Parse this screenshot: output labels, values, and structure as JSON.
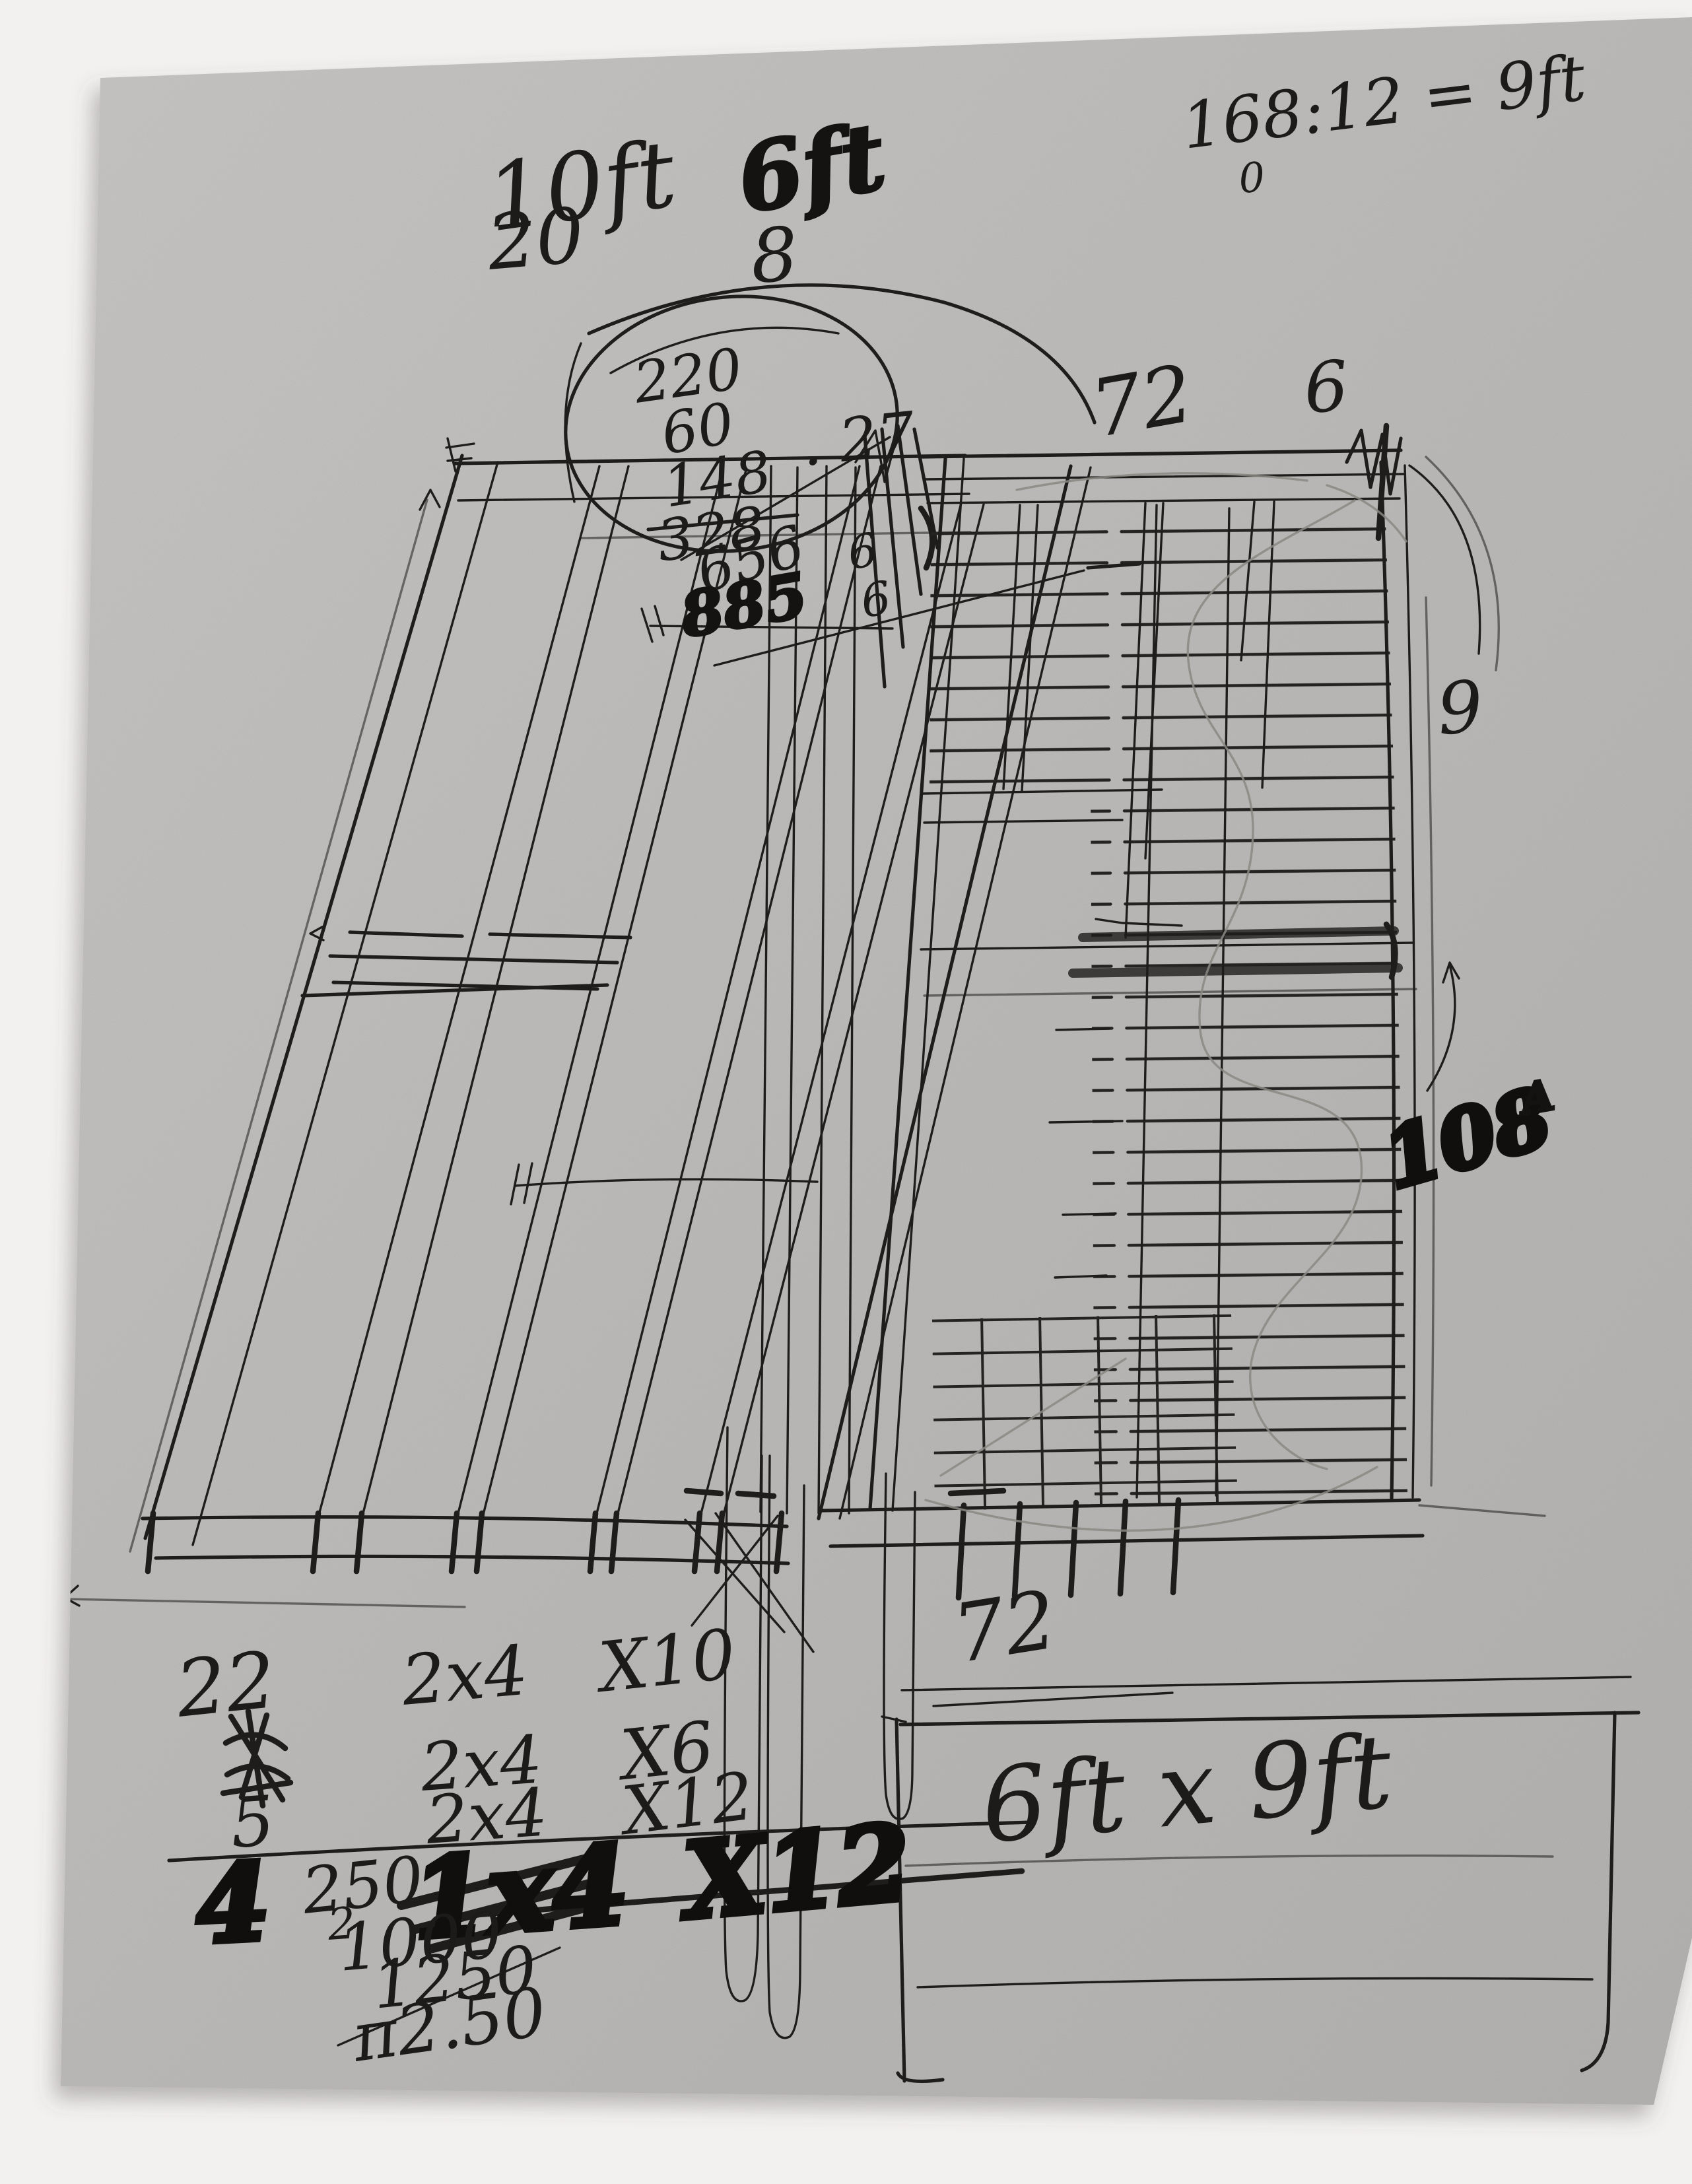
{
  "scene": {
    "background_color": "#f2f1ef",
    "paper_color": "#c2c1bf",
    "ink_color": "#1e1d1b",
    "pencil_color": "#8a8882"
  },
  "a": {
    "top": {
      "w10": "10ft",
      "w10_sub": "20",
      "w6": "6ft",
      "w6_sub": "8",
      "ratio": "168:12 = 9ft",
      "ratio_sub": "0"
    },
    "sum": {
      "l1": "220",
      "l2": "60",
      "l3": "148",
      "l4": "328",
      "l5": "656",
      "l6": "885",
      "side": ". 27",
      "m1": "6",
      "m2": "6"
    },
    "right": {
      "top_w": "72",
      "top_6": "6",
      "side_9": "9",
      "inches": "108",
      "inches_sup": "A"
    },
    "bottom_w": "72",
    "mat": {
      "r1": {
        "q": "22",
        "s": "2x4",
        "n": "X10"
      },
      "r2": {
        "q": "",
        "s": "2x4",
        "n": "X6"
      },
      "r3": {
        "q": "5",
        "s": "2x4",
        "n": "X12"
      },
      "f": {
        "q": "4",
        "p": "250",
        "s": "1x4",
        "n": "X12"
      },
      "sub": {
        "c": "2",
        "a": "1000",
        "b": "1250",
        "t": "π2.50"
      }
    },
    "box": "6ft x 9ft"
  }
}
